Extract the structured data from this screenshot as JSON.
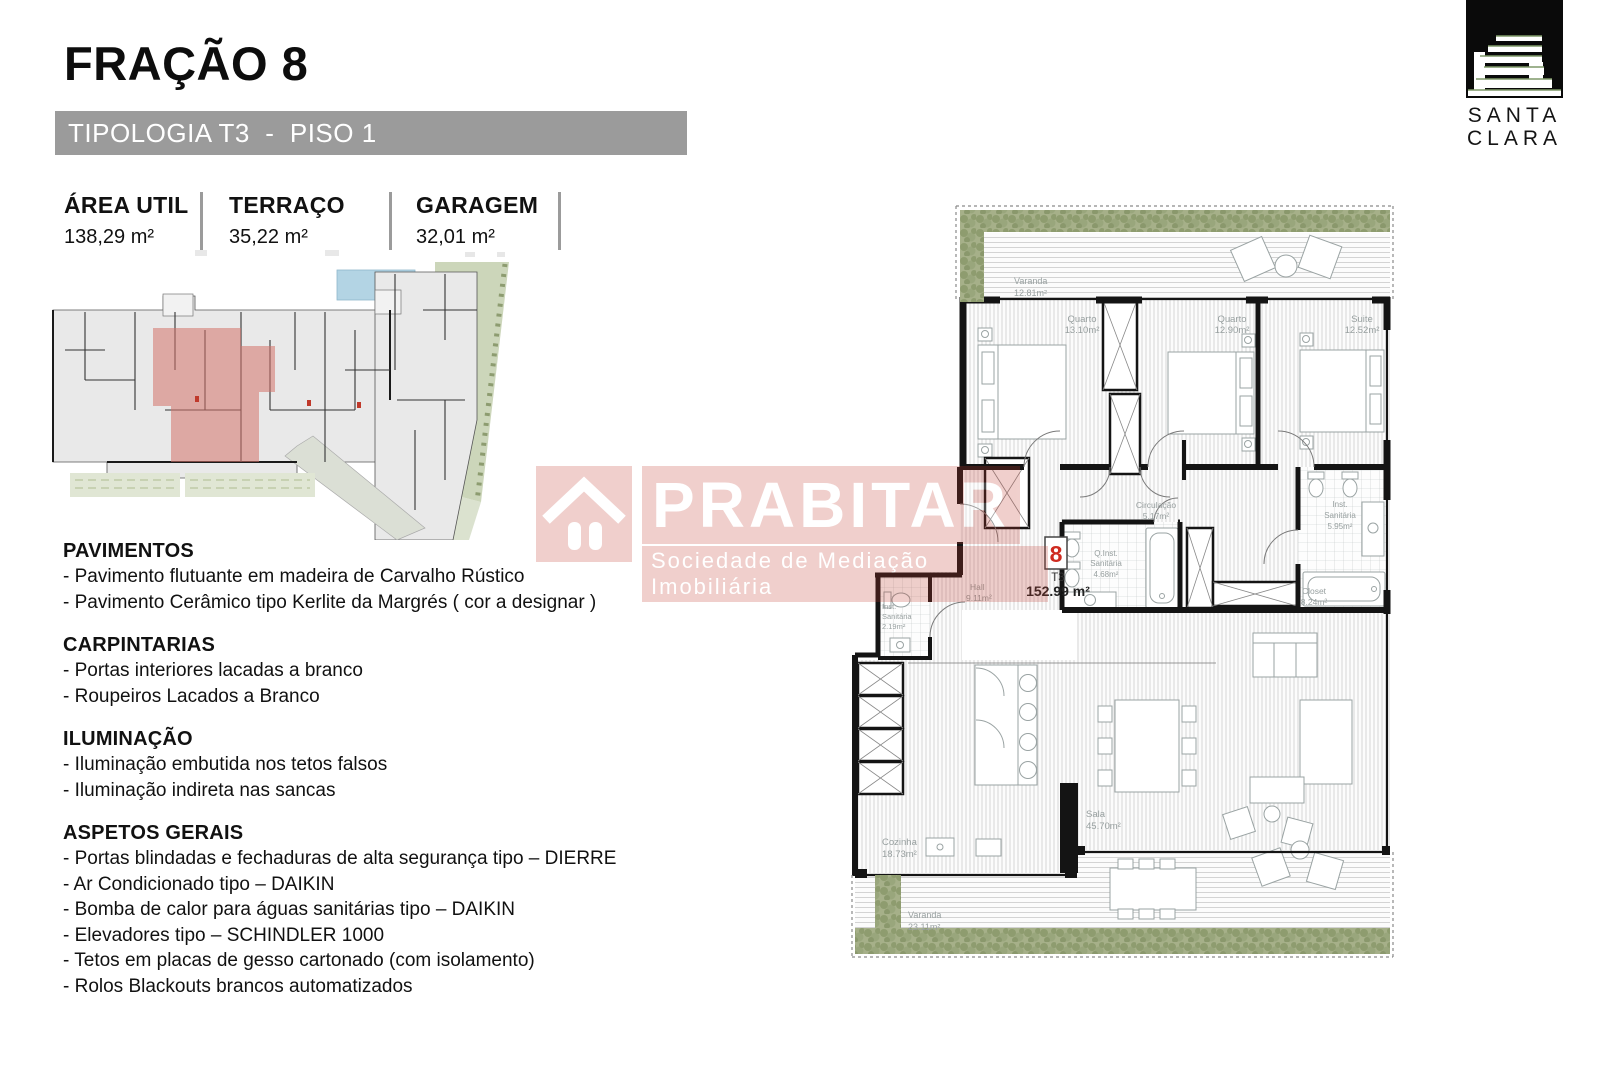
{
  "header": {
    "title": "FRAÇÃO 8",
    "type_bar": "TIPOLOGIA T3  -  PISO 1",
    "stats": [
      {
        "label": "ÁREA UTIL",
        "value": "138,29 m²"
      },
      {
        "label": "TERRAÇO",
        "value": "35,22 m²"
      },
      {
        "label": "GARAGEM",
        "value": "32,01 m²"
      }
    ]
  },
  "logo": {
    "line1": "SANTA",
    "line2": "CLARA"
  },
  "watermark": {
    "brand": "PRABITAR",
    "subtitle": "Sociedade de Mediação Imobiliária",
    "color": "#c23b2e"
  },
  "specs": {
    "sections": [
      {
        "heading": "PAVIMENTOS",
        "items": [
          "- Pavimento flutuante em madeira de Carvalho Rústico",
          "- Pavimento Cerâmico tipo Kerlite da Margrés ( cor a designar )"
        ]
      },
      {
        "heading": "CARPINTARIAS",
        "items": [
          "- Portas interiores lacadas a branco",
          "- Roupeiros Lacados a Branco"
        ]
      },
      {
        "heading": "ILUMINAÇÃO",
        "items": [
          "- Iluminação embutida nos tetos falsos",
          "- Iluminação indireta nas sancas"
        ]
      },
      {
        "heading": "ASPETOS GERAIS",
        "items": [
          "- Portas blindadas e fechaduras de alta segurança tipo – DIERRE",
          "- Ar Condicionado tipo – DAIKIN",
          "- Bomba de calor para águas sanitárias tipo – DAIKIN",
          "- Elevadores tipo – SCHINDLER 1000",
          "- Tetos em placas de gesso cartonado (com isolamento)",
          "- Rolos Blackouts brancos automatizados"
        ]
      }
    ]
  },
  "floor_plan": {
    "unit": {
      "number": "8",
      "type": "T3",
      "area": "152.99 m²"
    },
    "varanda_top": {
      "name": "Varanda",
      "area": "12.81m²"
    },
    "quarto1": {
      "name": "Quarto",
      "area": "13.10m²"
    },
    "quarto2": {
      "name": "Quarto",
      "area": "12.90m²"
    },
    "suite": {
      "name": "Suite",
      "area": "12.52m²"
    },
    "circulacao": {
      "name": "Circulação",
      "area": "5.17m²"
    },
    "inst_san_q": {
      "l1": "Q.Inst.",
      "l2": "Sanitária",
      "area": "4.68m²"
    },
    "inst_san_suite": {
      "l1": "Inst.",
      "l2": "Sanitária",
      "area": "5.95m²"
    },
    "inst_san_serv": {
      "l1": "Inst.",
      "l2": "Sanitária",
      "area": "2.19m²"
    },
    "closet": {
      "name": "Closet",
      "area": "8.24m²"
    },
    "hall": {
      "name": "Hall",
      "area": "9.11m²"
    },
    "cozinha": {
      "name": "Cozinha",
      "area": "18.73m²"
    },
    "sala": {
      "name": "Sala",
      "area": "45.70m²"
    },
    "varanda_bottom": {
      "name": "Varanda",
      "area": "23.11m²"
    }
  },
  "colors": {
    "type_bar_gray": "#9b9b9b",
    "watermark_red": "#c23b2e",
    "unit_number_red": "#cf2b20",
    "unit_highlight": "#d3726a",
    "hedge_green": "#a6b089",
    "plan_label_gray": "#98a0a0"
  }
}
